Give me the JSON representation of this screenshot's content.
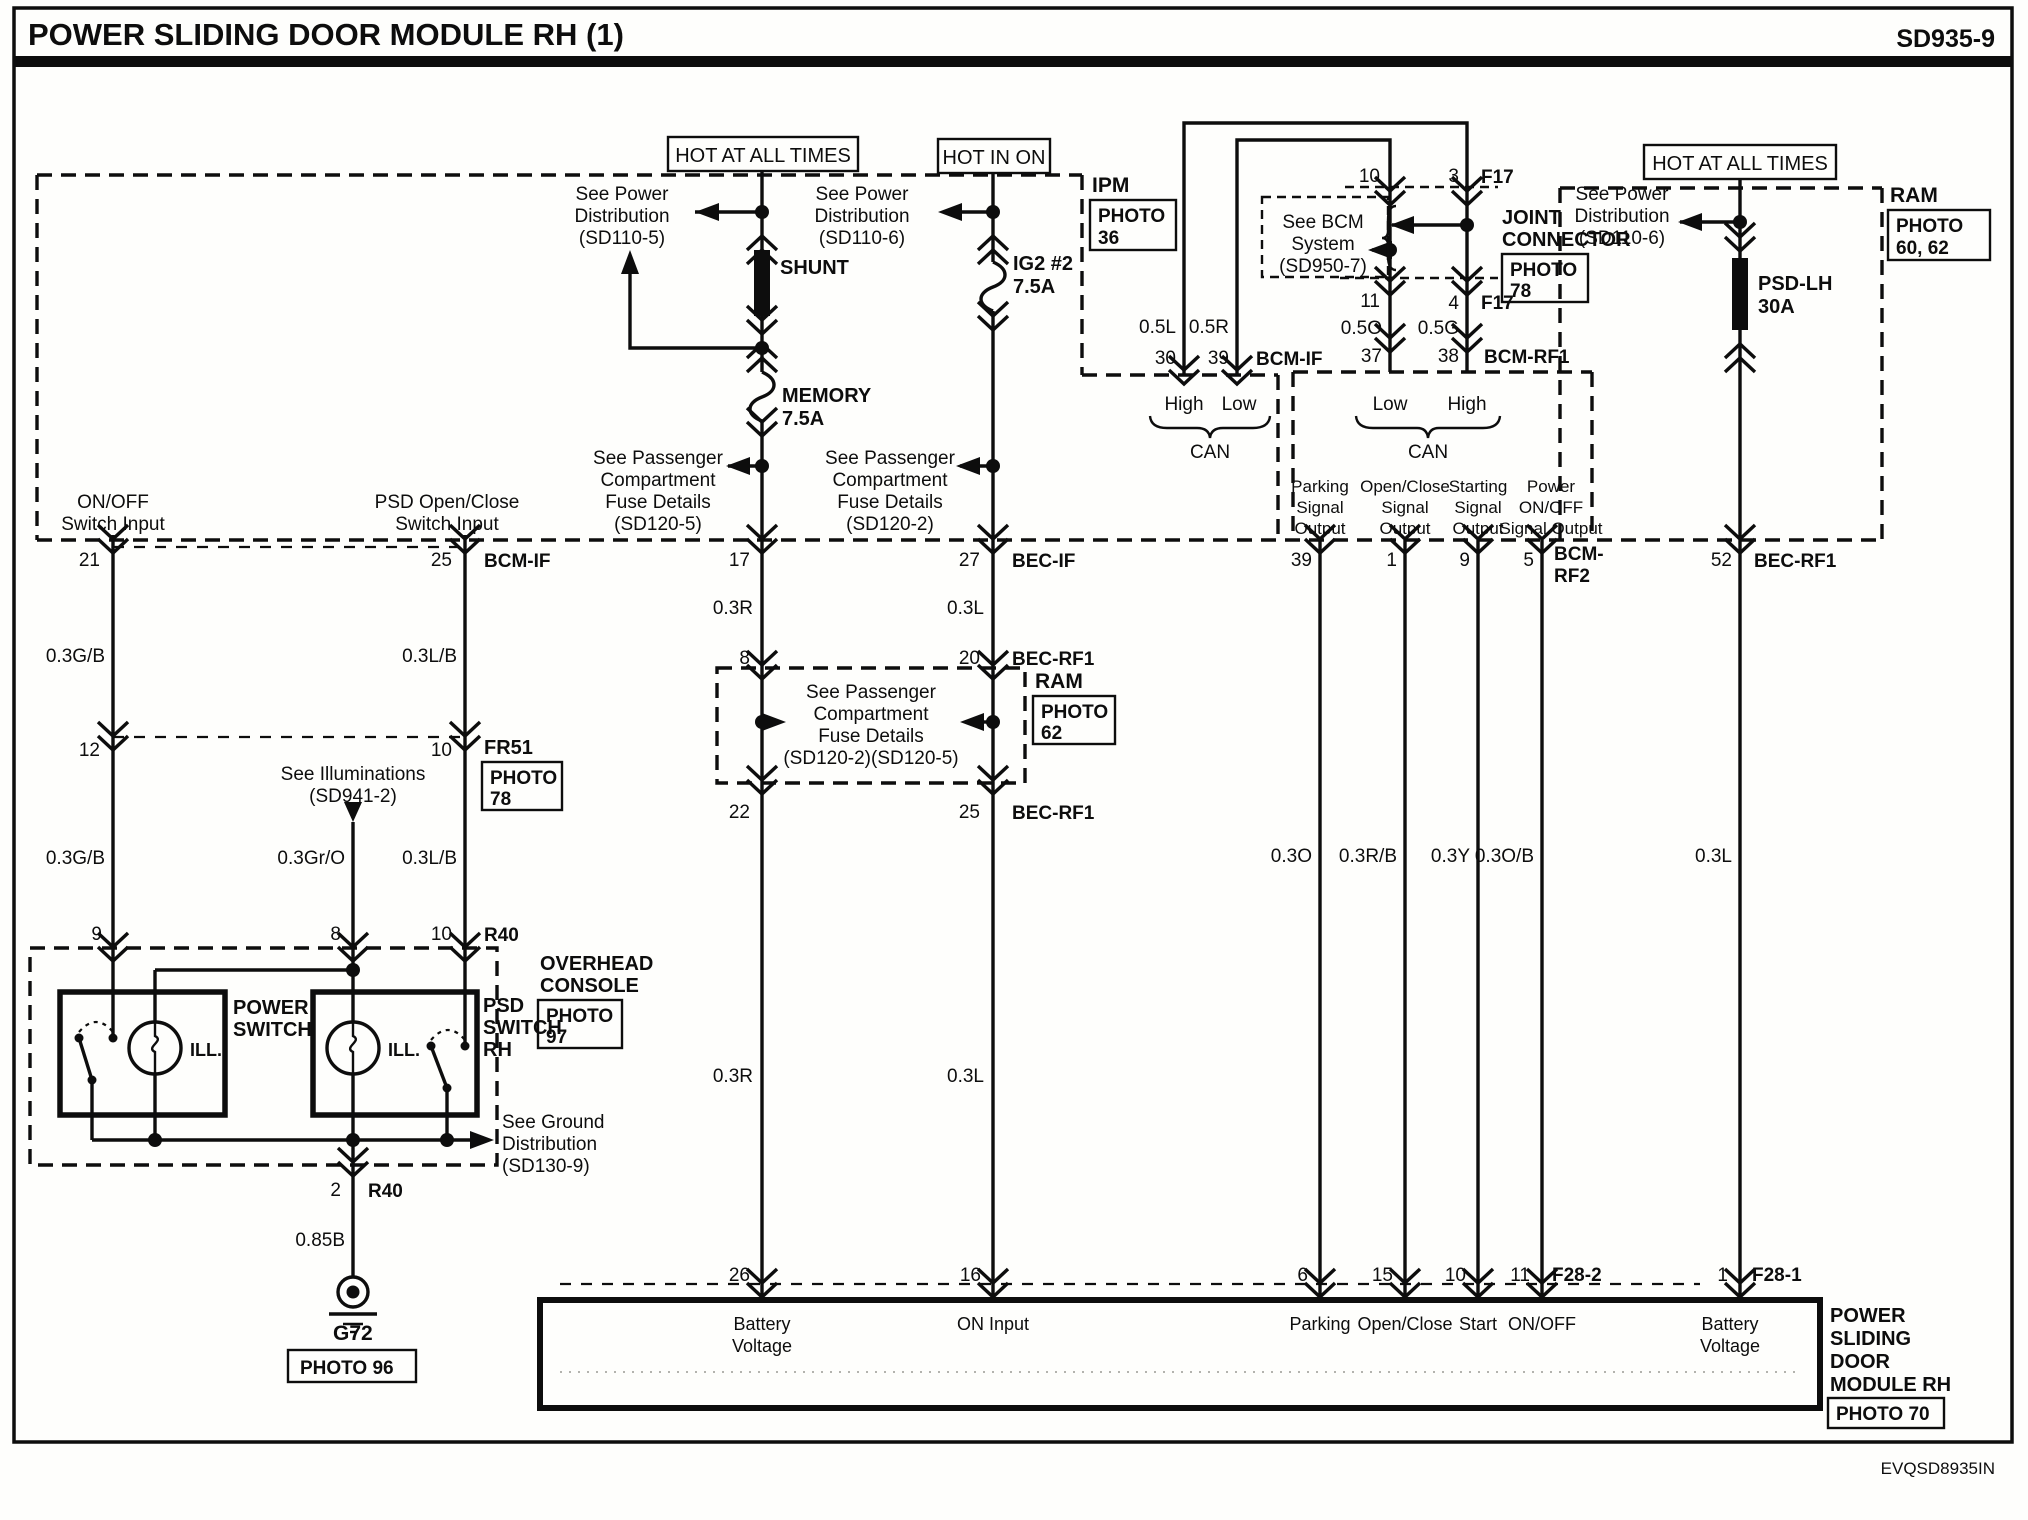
{
  "header": {
    "title": "POWER SLIDING DOOR MODULE RH (1)",
    "doc_code": "SD935-9"
  },
  "footer": {
    "code": "EVQSD8935IN"
  },
  "hot": {
    "left": "HOT AT ALL TIMES",
    "mid": "HOT IN ON",
    "right": "HOT AT ALL TIMES"
  },
  "see": {
    "pd5": [
      "See Power",
      "Distribution",
      "(SD110-5)"
    ],
    "pd6a": [
      "See Power",
      "Distribution",
      "(SD110-6)"
    ],
    "pd6b": [
      "See Power",
      "Distribution",
      "(SD110-6)"
    ],
    "pcf5": [
      "See Passenger",
      "Compartment",
      "Fuse Details",
      "(SD120-5)"
    ],
    "pcf2": [
      "See Passenger",
      "Compartment",
      "Fuse Details",
      "(SD120-2)"
    ],
    "pcf25": [
      "See Passenger",
      "Compartment",
      "Fuse Details",
      "(SD120-2)(SD120-5)"
    ],
    "bcm": [
      "See BCM",
      "System",
      "(SD950-7)"
    ],
    "illum": [
      "See Illuminations",
      "(SD941-2)"
    ],
    "gnd": [
      "See Ground",
      "Distribution",
      "(SD130-9)"
    ]
  },
  "fuses": {
    "shunt": "SHUNT",
    "memory": [
      "MEMORY",
      "7.5A"
    ],
    "ig2": [
      "IG2 #2",
      "7.5A"
    ],
    "psdlh": [
      "PSD-LH",
      "30A"
    ]
  },
  "badges": {
    "ipm": {
      "name": "IPM",
      "l1": "PHOTO",
      "l2": "36"
    },
    "joint": {
      "n1": "JOINT",
      "n2": "CONNECTOR",
      "l1": "PHOTO",
      "l2": "78"
    },
    "ram_top": {
      "name": "RAM",
      "l1": "PHOTO",
      "l2": "60, 62"
    },
    "ram_mid": {
      "name": "RAM",
      "l1": "PHOTO",
      "l2": "62"
    },
    "fr51": {
      "name": "FR51",
      "l1": "PHOTO",
      "l2": "78"
    },
    "overhead": {
      "n1": "OVERHEAD",
      "n2": "CONSOLE",
      "l1": "PHOTO",
      "l2": "97"
    },
    "gnd": {
      "name": "G72",
      "label": "PHOTO 96"
    },
    "module": {
      "n1": "POWER",
      "n2": "SLIDING",
      "n3": "DOOR",
      "n4": "MODULE RH",
      "label": "PHOTO 70"
    }
  },
  "inputs": {
    "onoff": [
      "ON/OFF",
      "Switch Input"
    ],
    "psd": [
      "PSD Open/Close",
      "Switch Input"
    ]
  },
  "outputs": {
    "parking": [
      "Parking",
      "Signal",
      "Output"
    ],
    "openclose": [
      "Open/Close",
      "Signal",
      "Output"
    ],
    "starting": [
      "Starting",
      "Signal",
      "Output"
    ],
    "power": [
      "Power",
      "ON/OFF",
      "Signal Output"
    ]
  },
  "can_left": {
    "a": "High",
    "b": "Low",
    "bus": "CAN"
  },
  "can_right": {
    "a": "Low",
    "b": "High",
    "bus": "CAN"
  },
  "switches": {
    "power": [
      "POWER",
      "SWITCH"
    ],
    "psd": [
      "PSD",
      "SWITCH",
      "RH"
    ],
    "ill1": "ILL.",
    "ill2": "ILL."
  },
  "pins": {
    "p21": "21",
    "p25": "25",
    "bcmif1": "BCM-IF",
    "p17": "17",
    "p27": "27",
    "becif": "BEC-IF",
    "p8": "8",
    "p20": "20",
    "becrf1a": "BEC-RF1",
    "p22": "22",
    "p25b": "25",
    "becrf1b": "BEC-RF1",
    "p12": "12",
    "p10a": "10",
    "p9": "9",
    "p8b": "8",
    "p10b": "10",
    "r40a": "R40",
    "p2": "2",
    "r40b": "R40",
    "p30": "30",
    "p39": "39",
    "bcmif2": "BCM-IF",
    "p37": "37",
    "p38": "38",
    "bcmrf1": "BCM-RF1",
    "j10": "10",
    "j3": "3",
    "f17a": "F17",
    "j11": "11",
    "j4": "4",
    "f17b": "F17",
    "o39": "39",
    "o1": "1",
    "o9": "9",
    "o5": "5",
    "bcmrf2a": "BCM-",
    "bcmrf2b": "RF2",
    "o52": "52",
    "becrf1c": "BEC-RF1",
    "m26": "26",
    "m16": "16",
    "m6": "6",
    "m15": "15",
    "m10": "10",
    "m11": "11",
    "f282": "F28-2",
    "m1": "1",
    "f281": "F28-1"
  },
  "wires": {
    "gb1": "0.3G/B",
    "gb2": "0.3G/B",
    "lb1": "0.3L/B",
    "lb2": "0.3L/B",
    "gro": "0.3Gr/O",
    "r1": "0.3R",
    "r2": "0.3R",
    "l1": "0.3L",
    "l2": "0.3L",
    "b85": "0.85B",
    "w5l": "0.5L",
    "w5r": "0.5R",
    "w5o": "0.5O",
    "w5g": "0.5G",
    "o3": "0.3O",
    "rb3": "0.3R/B",
    "y3": "0.3Y",
    "ob3": "0.3O/B",
    "l3": "0.3L"
  },
  "module_row": {
    "batt1a": "Battery",
    "batt1b": "Voltage",
    "on_input": "ON Input",
    "parking": "Parking",
    "openclose": "Open/Close",
    "start": "Start",
    "onoff": "ON/OFF",
    "batt2a": "Battery",
    "batt2b": "Voltage"
  }
}
